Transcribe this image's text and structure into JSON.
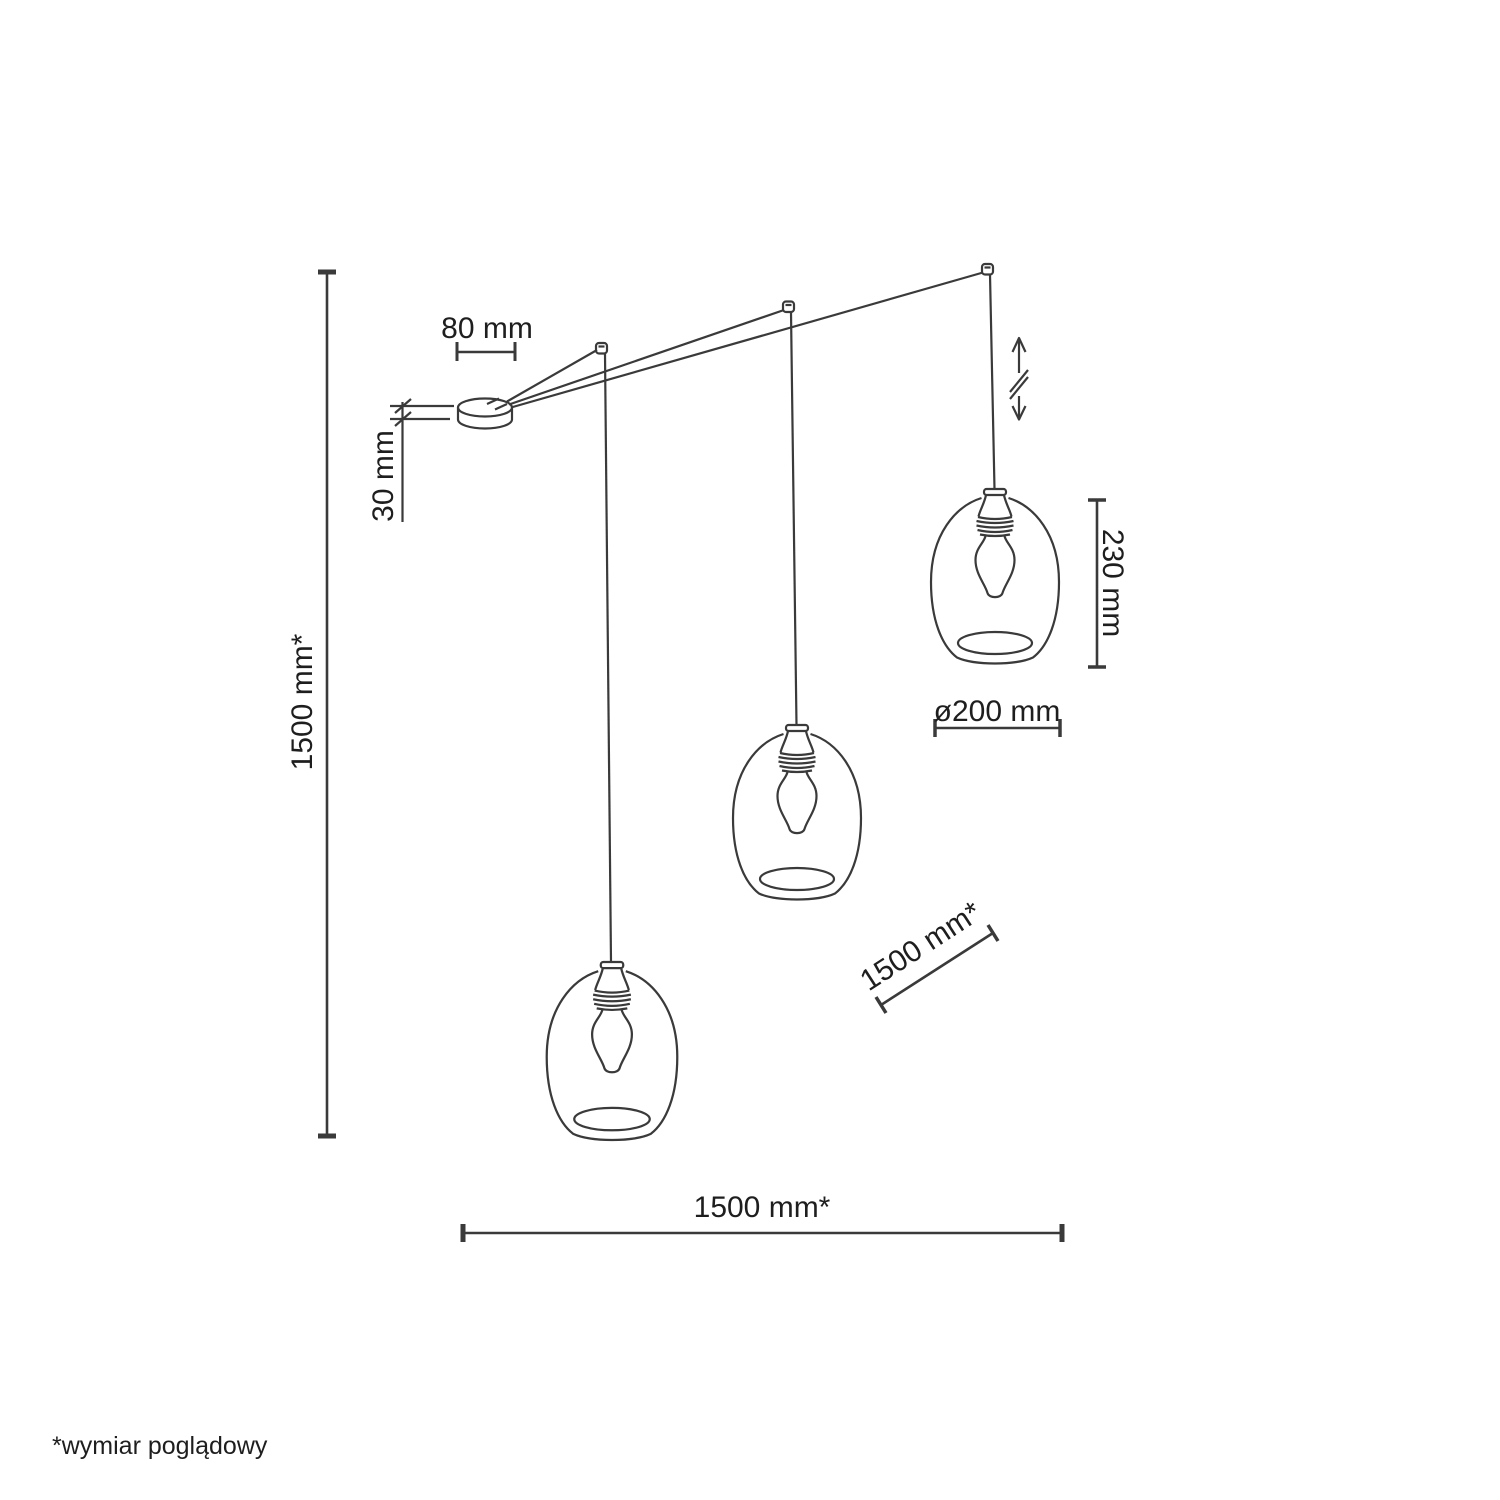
{
  "colors": {
    "line": "#3a3a3a",
    "text": "#1e1e1e",
    "background": "#ffffff"
  },
  "diagram": {
    "pendant_count": 3,
    "labels": {
      "canopy_width": "80 mm",
      "canopy_height": "30 mm",
      "total_height": "1500 mm*",
      "shade_height": "230 mm",
      "shade_diameter": "ø200 mm",
      "cable_length": "1500 mm*",
      "span_width": "1500 mm*"
    },
    "footnote": "*wymiar poglądowy"
  }
}
